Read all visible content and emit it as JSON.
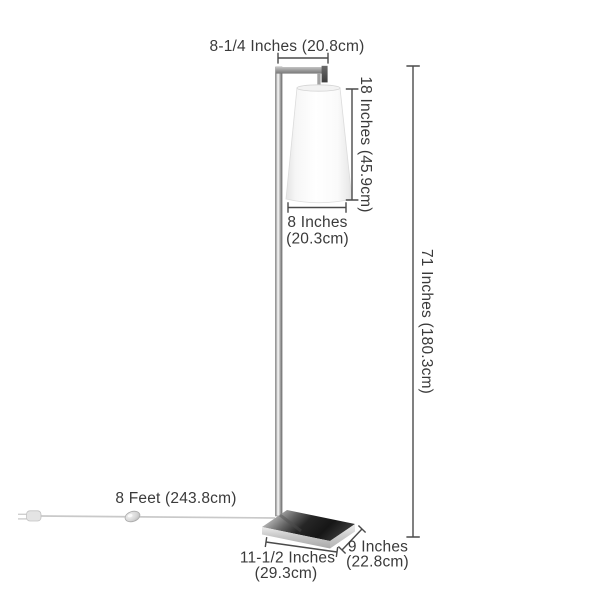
{
  "diagram": {
    "name": "floor-lamp-dimension-diagram",
    "colors": {
      "background": "#ffffff",
      "label_text": "#3a3a3a",
      "dimension_line": "#4a4a4a",
      "chrome_light": "#e8e8e8",
      "chrome_dark": "#1f1f1f",
      "shade_white": "#ffffff",
      "cord_gray": "#c9c9c9"
    },
    "dimensions": {
      "arm_width": {
        "label": "8-1/4 Inches (20.8cm)"
      },
      "shade_height": {
        "label": "18 Inches (45.9cm)"
      },
      "shade_width": {
        "line1": "8 Inches",
        "line2": "(20.3cm)"
      },
      "total_height": {
        "label": "71 Inches (180.3cm)"
      },
      "cord_length": {
        "label": "8 Feet (243.8cm)"
      },
      "base_width": {
        "line1": "11-1/2 Inches",
        "line2": "(29.3cm)"
      },
      "base_depth": {
        "line1": "9 Inches",
        "line2": "(22.8cm)"
      }
    }
  }
}
